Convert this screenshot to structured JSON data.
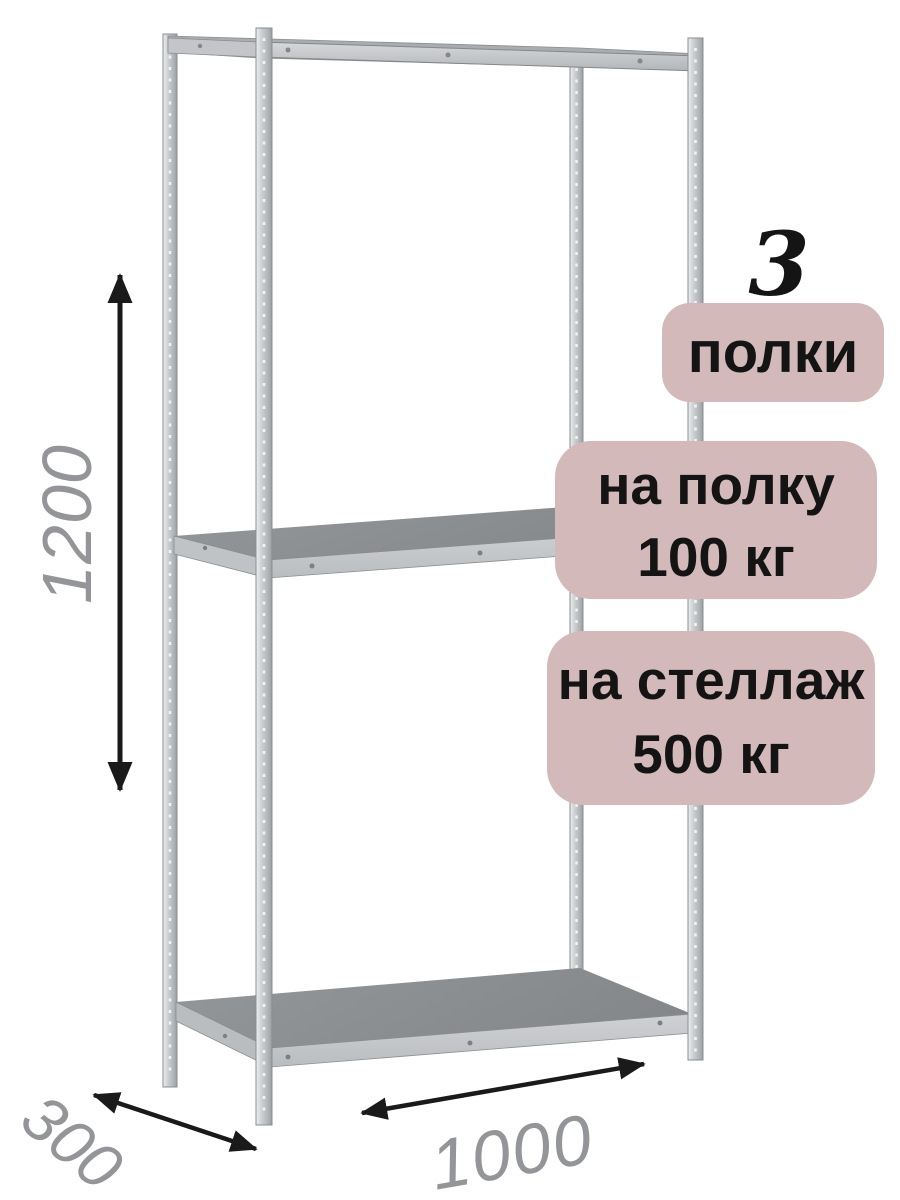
{
  "product_illustration": "metal-boltless-shelving-rack-3-shelves",
  "badges": {
    "shelf_count_number": "3",
    "shelf_count_label": "полки",
    "per_shelf_line1": "на полку",
    "per_shelf_line2": "100 кг",
    "per_rack_line1": "на стеллаж",
    "per_rack_line2": "500 кг"
  },
  "dimensions": {
    "height": "1200",
    "depth": "300",
    "width": "1000"
  },
  "colors": {
    "badge_bg": "#d3b9b9",
    "badge_text": "#141414",
    "dim_text": "#949598",
    "arrow": "#1a1a1a",
    "metal_light": "#d8dadc",
    "metal_mid": "#c3c5c8",
    "shelf_top": "#8c8f92"
  }
}
